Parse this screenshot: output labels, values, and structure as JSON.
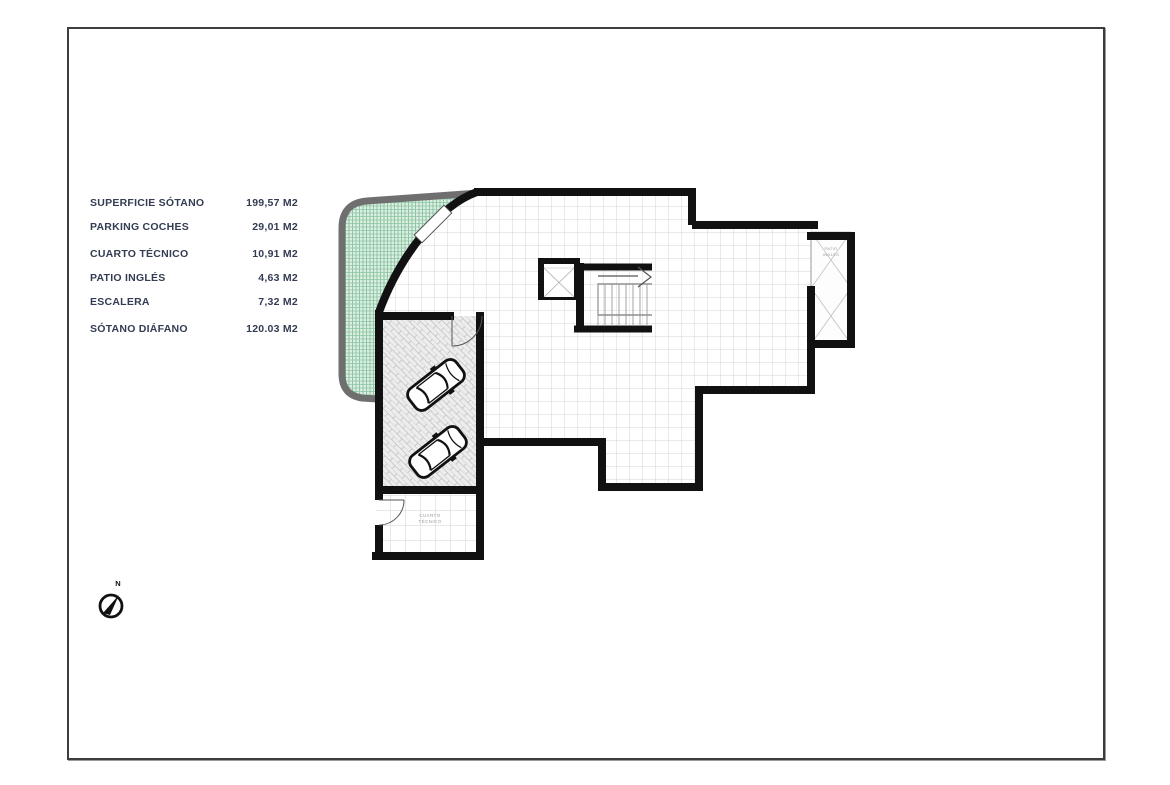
{
  "document": {
    "type": "architectural-basement-floor-plan",
    "frame_color": "#3d3d3d",
    "paper_color": "#ffffff"
  },
  "legend": {
    "text_color": "#333c52",
    "items": [
      {
        "label": "SUPERFICIE SÓTANO",
        "value": "199,57 M2"
      },
      {
        "label": "PARKING COCHES",
        "value": "29,01 M2"
      },
      {
        "label": "CUARTO TÉCNICO",
        "value": "10,91 M2"
      },
      {
        "label": "PATIO INGLÉS",
        "value": "4,63 M2"
      },
      {
        "label": "ESCALERA",
        "value": "7,32 M2"
      },
      {
        "label": "SÓTANO DIÁFANO",
        "value": "120.03 M2"
      }
    ]
  },
  "compass": {
    "north_label": "N"
  },
  "plan": {
    "colors": {
      "wall": "#111111",
      "outer_retaining_wall": "#6f6f6f",
      "green_area_fill": "#ddeee3",
      "green_area_hatch": "#8fc6a6",
      "floor_grid": "#d6d6d6",
      "room_label": "#9a9a9a"
    },
    "labels": {
      "patio_line1": "PATIO",
      "patio_line2": "INGLÉS",
      "cuarto_line1": "CUARTO",
      "cuarto_line2": "TÉCNICO"
    }
  }
}
